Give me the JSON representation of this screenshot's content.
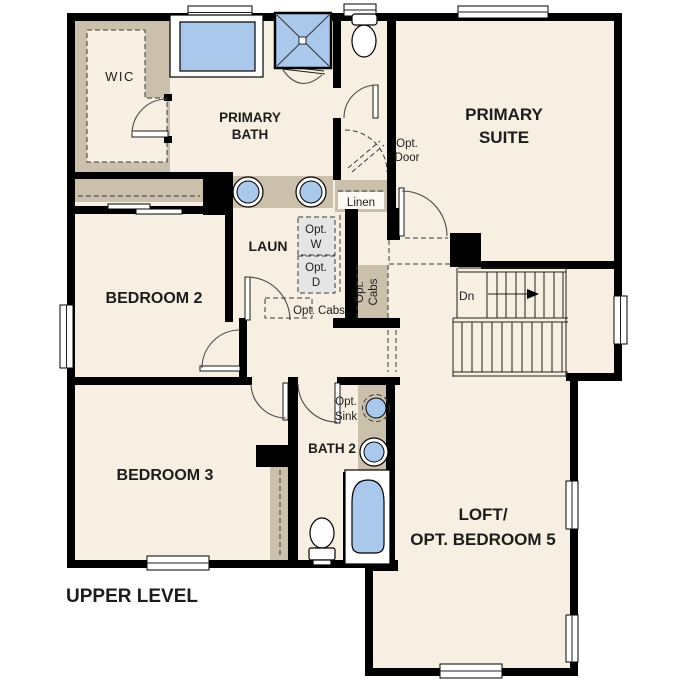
{
  "plan": {
    "title": "UPPER LEVEL",
    "rooms": {
      "wic": {
        "label": "WIC"
      },
      "primary_bath": {
        "line1": "PRIMARY",
        "line2": "BATH"
      },
      "primary_suite": {
        "line1": "PRIMARY",
        "line2": "SUITE"
      },
      "bedroom2": {
        "label": "BEDROOM 2"
      },
      "bedroom3": {
        "label": "BEDROOM 3"
      },
      "bath2": {
        "label": "BATH 2"
      },
      "laundry": {
        "label": "LAUN"
      },
      "loft": {
        "line1": "LOFT/",
        "line2": "OPT. BEDROOM 5"
      }
    },
    "annotations": {
      "linen": "Linen",
      "opt_door": {
        "line1": "Opt.",
        "line2": "Door"
      },
      "opt_washer": {
        "line1": "Opt.",
        "line2": "W"
      },
      "opt_dryer": {
        "line1": "Opt.",
        "line2": "D"
      },
      "opt_cabs_hall": "Opt. Cabs",
      "opt_cabs_vertical": {
        "line1": "Opt.",
        "line2": "Cabs"
      },
      "opt_sink": {
        "line1": "Opt.",
        "line2": "Sink"
      },
      "stairs_down": "Dn"
    },
    "icons": [
      "bathtub-icon",
      "shower-icon",
      "double-sink-vanity-icon",
      "toilet-icon",
      "washer-icon",
      "dryer-icon",
      "staircase-icon",
      "window-icon",
      "door-swing-icon"
    ],
    "colors": {
      "floor": "#f7f0e2",
      "wall": "#000000",
      "casework_tan": "#cbc0ac",
      "fixture_blue": "#a9c8eb",
      "appliance_gray": "#e5e5e5",
      "background": "#ffffff"
    }
  }
}
